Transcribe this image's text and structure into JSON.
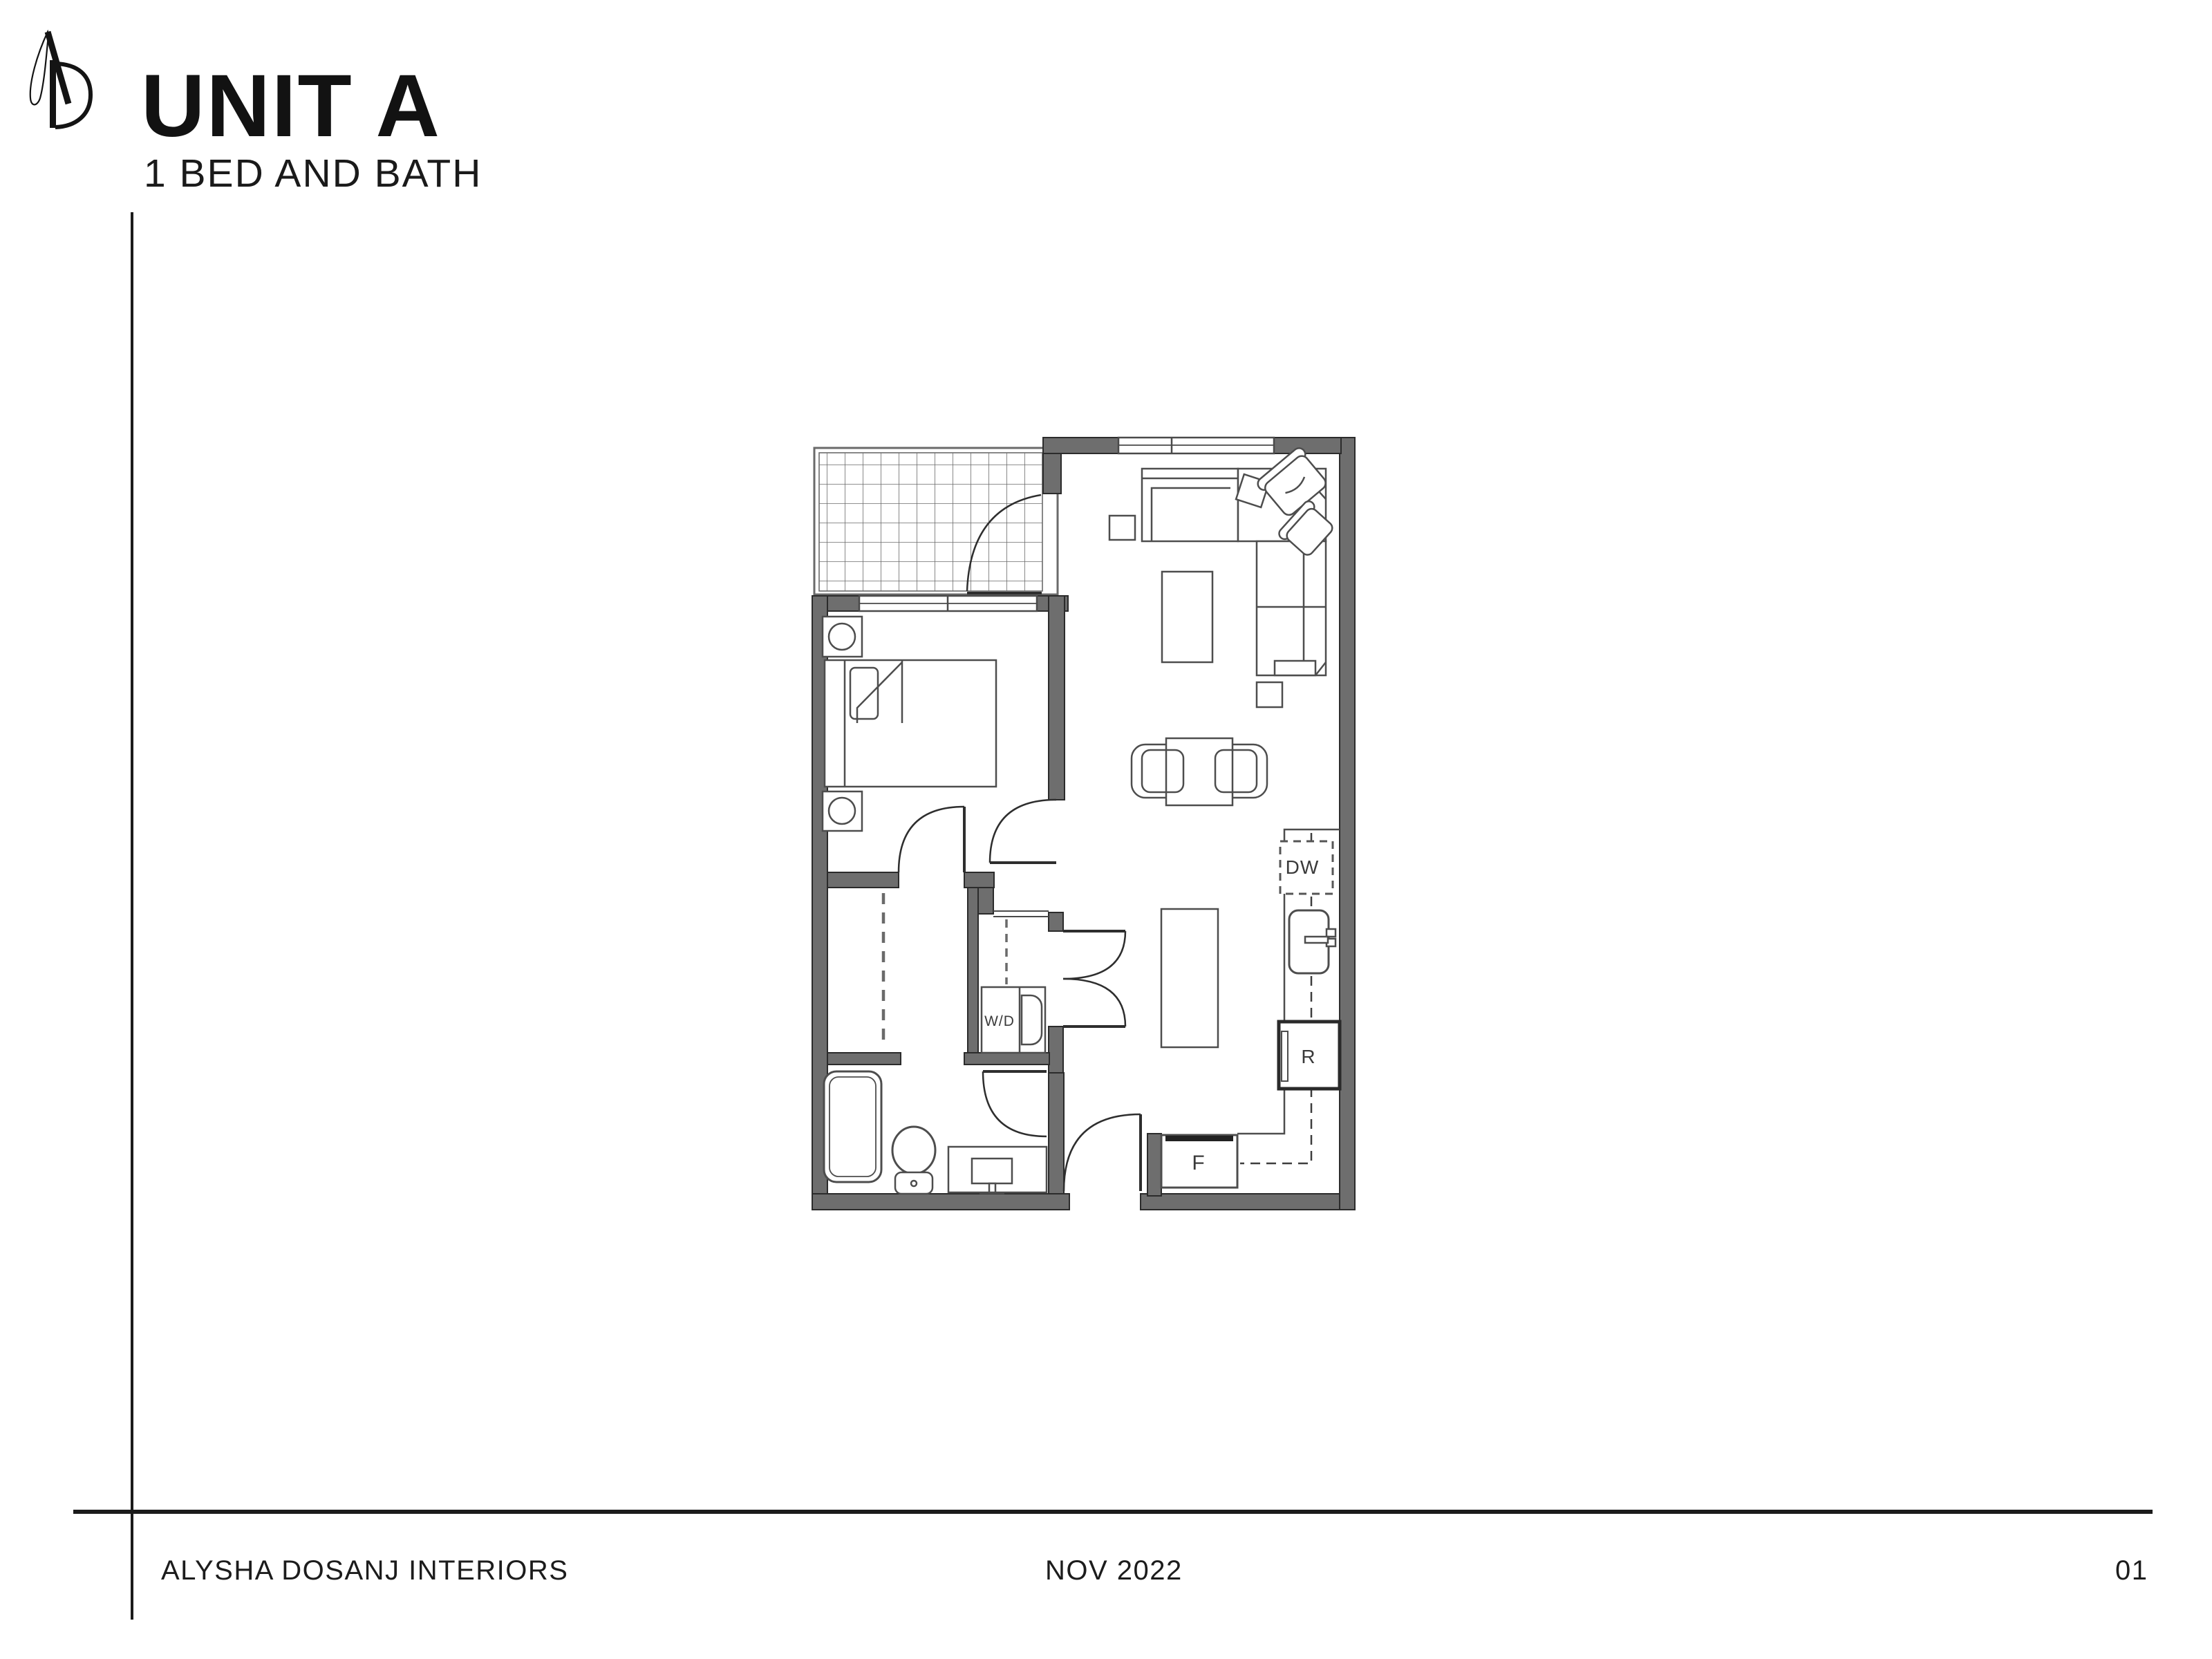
{
  "header": {
    "title": "UNIT A",
    "subtitle": "1 BED AND BATH",
    "logo_icon": "ad-monogram-icon"
  },
  "floor_plan": {
    "name": "unit-a-one-bed-one-bath-plan",
    "labels": {
      "dishwasher": "DW",
      "washer_dryer": "W/D",
      "range": "R",
      "fridge": "F"
    },
    "colors": {
      "wall_fill": "#6e6e6e",
      "wall_stroke": "#2b2b2b",
      "furniture_line": "#4d4d4d",
      "accent": "#1b1b1b"
    }
  },
  "footer": {
    "studio": "ALYSHA DOSANJ INTERIORS",
    "date": "NOV 2022",
    "page_number": "01"
  }
}
